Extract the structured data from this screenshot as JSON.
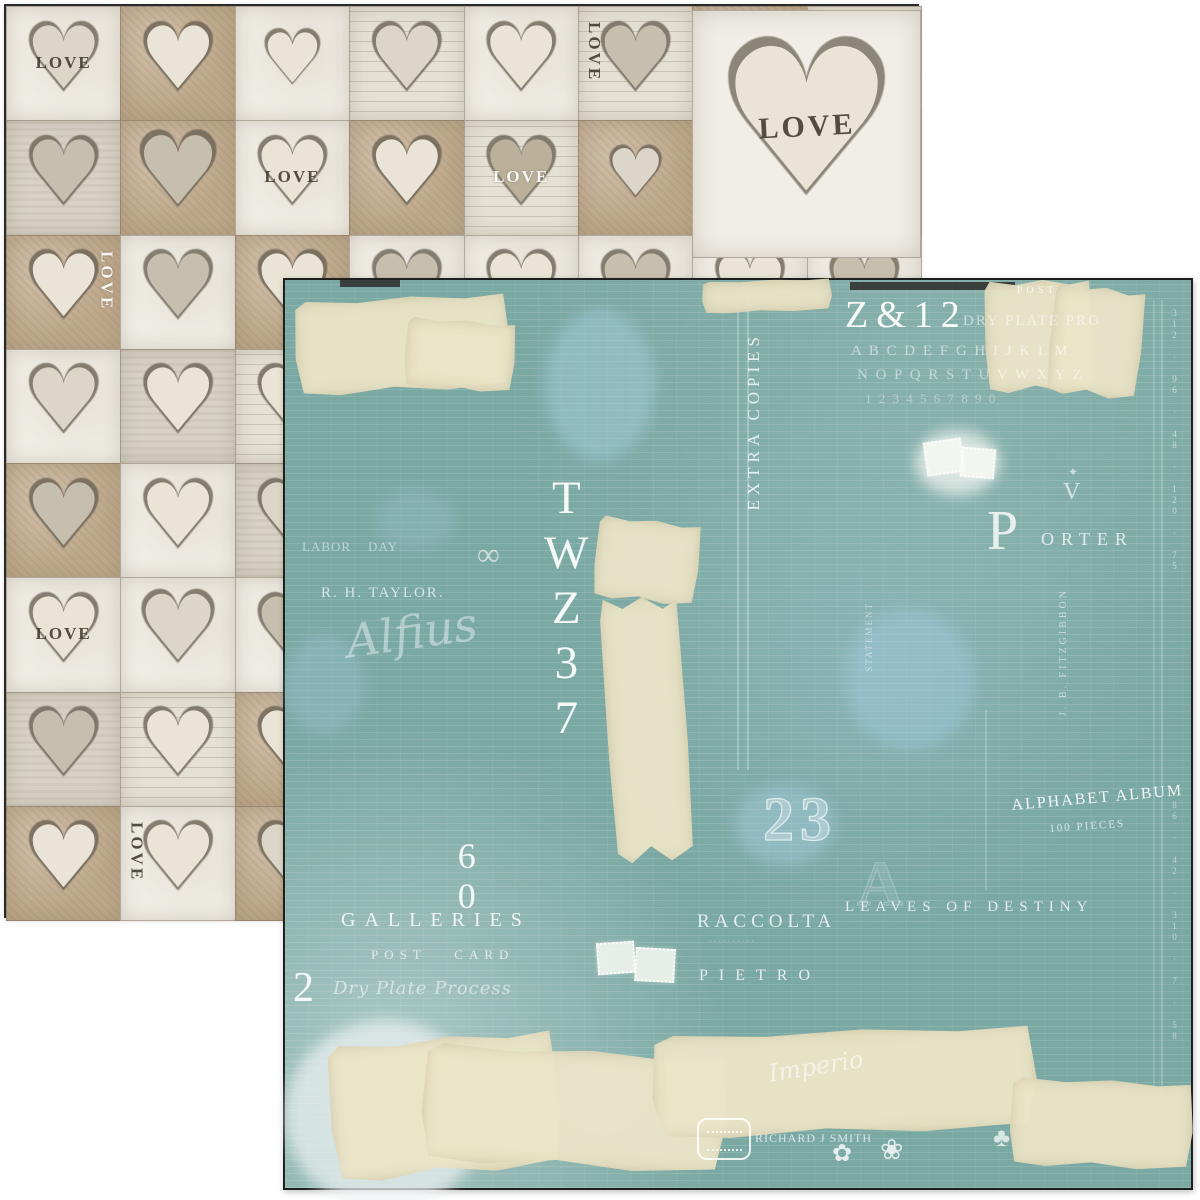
{
  "scene": {
    "description": "Two overlapping square sheets of double-sided vintage scrapbook paper: hearts LOVE pattern side behind, teal ledger typographic collage side in front",
    "background_color": "#ffffff"
  },
  "back_paper": {
    "name": "hearts-love-side",
    "border_color": "#2a2a28",
    "background_color": "#ded8cb",
    "heart_glyph": "♥",
    "love_text": "LOVE",
    "grid": {
      "cols": 8,
      "rows": 8
    },
    "cell_colors": {
      "tan": "#bfa98c",
      "white": "#f0ede5",
      "gray": "#d7d2c5",
      "script": "#e4e0d4"
    },
    "heart_colors": {
      "cream": "#e9e4d6",
      "gray": "#c6bfae",
      "pale": "#dbd6c8",
      "dark": "#bbb09a",
      "outline": "#6b6355"
    },
    "cells": [
      {
        "c": 0,
        "r": 0,
        "b": "white",
        "h": "pale",
        "l": "LOVE",
        "lp": "center",
        "lo": "h",
        "lc": "dark"
      },
      {
        "c": 1,
        "r": 0,
        "b": "tan",
        "h": "cream"
      },
      {
        "c": 2,
        "r": 0,
        "b": "white",
        "h": "cream",
        "s": 0.8
      },
      {
        "c": 3,
        "r": 0,
        "b": "script",
        "h": "pale"
      },
      {
        "c": 4,
        "r": 0,
        "b": "white",
        "h": "cream"
      },
      {
        "c": 5,
        "r": 0,
        "b": "script",
        "h": "gray",
        "l": "LOVE",
        "lp": "left",
        "lo": "v",
        "lc": "dark"
      },
      {
        "c": 0,
        "r": 1,
        "b": "gray",
        "h": "gray"
      },
      {
        "c": 1,
        "r": 1,
        "b": "tan",
        "h": "gray",
        "s": 1.1
      },
      {
        "c": 2,
        "r": 1,
        "b": "white",
        "h": "cream",
        "l": "LOVE",
        "lp": "center",
        "lo": "h",
        "lc": "dark"
      },
      {
        "c": 3,
        "r": 1,
        "b": "tan",
        "h": "cream"
      },
      {
        "c": 4,
        "r": 1,
        "b": "script",
        "h": "dark",
        "l": "LOVE",
        "lp": "center",
        "lo": "h",
        "lc": "white"
      },
      {
        "c": 5,
        "r": 1,
        "b": "tan",
        "h": "pale",
        "s": 0.75
      },
      {
        "c": 0,
        "r": 2,
        "b": "tan",
        "h": "cream",
        "l": "LOVE",
        "lp": "right",
        "lo": "v",
        "lc": "white"
      },
      {
        "c": 1,
        "r": 2,
        "b": "white",
        "h": "gray"
      },
      {
        "c": 2,
        "r": 2,
        "b": "tan",
        "h": "cream"
      },
      {
        "c": 0,
        "r": 3,
        "b": "white",
        "h": "pale"
      },
      {
        "c": 1,
        "r": 3,
        "b": "gray",
        "h": "cream"
      },
      {
        "c": 0,
        "r": 4,
        "b": "tan",
        "h": "gray"
      },
      {
        "c": 1,
        "r": 4,
        "b": "white",
        "h": "cream"
      },
      {
        "c": 0,
        "r": 5,
        "b": "white",
        "h": "cream",
        "l": "LOVE",
        "lp": "center",
        "lo": "h",
        "lc": "dark"
      },
      {
        "c": 1,
        "r": 5,
        "b": "white",
        "h": "pale",
        "s": 1.05
      },
      {
        "c": 0,
        "r": 6,
        "b": "gray",
        "h": "gray"
      },
      {
        "c": 1,
        "r": 6,
        "b": "script",
        "h": "cream"
      },
      {
        "c": 0,
        "r": 7,
        "b": "tan",
        "h": "cream"
      },
      {
        "c": 1,
        "r": 7,
        "b": "white",
        "h": "cream",
        "l": "LOVE",
        "lp": "left",
        "lo": "v",
        "lc": "dark"
      }
    ],
    "big_heart": {
      "label": "LOVE",
      "x": 686,
      "y": 4,
      "w": 229,
      "h": 248
    }
  },
  "front_paper": {
    "name": "teal-ledger-side",
    "border_color": "#1f1f1e",
    "base_color": "#7aa8a2",
    "tape_color": "#ebe4c8",
    "ink_color": "#ffffff",
    "texts": [
      {
        "n": "code-z12",
        "t": "Z&12",
        "x": 560,
        "y": 16,
        "fs": 38,
        "ls": 8,
        "st": "serif",
        "op": 0.95
      },
      {
        "n": "dry-plate-top",
        "t": "Dry Plate Pro",
        "x": 678,
        "y": 34,
        "fs": 15,
        "ls": 2,
        "st": "serifcaps",
        "op": 0.55
      },
      {
        "n": "post-label",
        "t": "POST",
        "x": 732,
        "y": 6,
        "fs": 10,
        "ls": 4,
        "st": "serif",
        "op": 0.75
      },
      {
        "n": "alphabet-row-1",
        "t": "A B C D E F G H I J K L M",
        "x": 566,
        "y": 64,
        "fs": 15,
        "ls": 2,
        "st": "serifcaps",
        "op": 0.55
      },
      {
        "n": "alphabet-row-2",
        "t": "N O P Q R S T U V W X Y Z",
        "x": 572,
        "y": 88,
        "fs": 15,
        "ls": 2,
        "st": "serifcaps",
        "op": 0.5
      },
      {
        "n": "alphabet-row-3",
        "t": "1 2 3 4 5 6 7 8 9 0",
        "x": 580,
        "y": 112,
        "fs": 13,
        "ls": 2,
        "st": "serifcaps",
        "op": 0.38
      },
      {
        "n": "extra-copies",
        "t": "EXTRA COPIES",
        "x": 460,
        "y": 52,
        "fs": 17,
        "ls": 5,
        "st": "vertup",
        "op": 0.8
      },
      {
        "n": "twz37",
        "t": "TWZ37",
        "x": 256,
        "y": 192,
        "fs": 47,
        "ls": 3,
        "st": "vert",
        "op": 0.92
      },
      {
        "n": "infinity-mark",
        "t": "∞",
        "x": 192,
        "y": 258,
        "fs": 32,
        "st": "serif",
        "op": 0.6
      },
      {
        "n": "label-day",
        "t": "Labor    Day",
        "x": 17,
        "y": 260,
        "fs": 13,
        "ls": 1,
        "st": "serifcaps",
        "op": 0.5
      },
      {
        "n": "rh-taylor",
        "t": "R. H. TAYLOR.",
        "x": 36,
        "y": 306,
        "fs": 15,
        "ls": 2,
        "st": "serifcaps",
        "op": 0.7
      },
      {
        "n": "handwriting-1",
        "t": "Alfius",
        "x": 58,
        "y": 338,
        "fs": 46,
        "st": "script",
        "op": 0.42,
        "rot": -8
      },
      {
        "n": "statement-vert",
        "t": "STATEMENT",
        "x": 580,
        "y": 322,
        "fs": 9,
        "ls": 2,
        "st": "vertup",
        "op": 0.5
      },
      {
        "n": "porter-initial",
        "t": "P",
        "x": 702,
        "y": 222,
        "fs": 56,
        "st": "serif",
        "op": 0.8
      },
      {
        "n": "porter-word",
        "t": "ORTER",
        "x": 756,
        "y": 250,
        "fs": 18,
        "ls": 7,
        "st": "serifcaps",
        "op": 0.75
      },
      {
        "n": "crest-ornament",
        "t": "V",
        "x": 778,
        "y": 200,
        "fs": 24,
        "st": "serif",
        "op": 0.65
      },
      {
        "n": "crest-star",
        "t": "✦",
        "x": 783,
        "y": 186,
        "fs": 12,
        "st": "serif",
        "op": 0.6
      },
      {
        "n": "fitzgibbon",
        "t": "J. B. FITZGIBBON",
        "x": 774,
        "y": 308,
        "fs": 10,
        "ls": 3,
        "st": "vertup",
        "op": 0.55
      },
      {
        "n": "alphabet-album",
        "t": "ALPHABET ALBUM",
        "x": 726,
        "y": 518,
        "fs": 16,
        "ls": 2,
        "st": "serifcaps",
        "op": 0.9,
        "rot": -5
      },
      {
        "n": "album-pieces",
        "t": "100 PIECES",
        "x": 764,
        "y": 544,
        "fs": 11,
        "ls": 2,
        "st": "serifcaps",
        "op": 0.7,
        "rot": -4
      },
      {
        "n": "number-23",
        "t": "23",
        "x": 478,
        "y": 508,
        "fs": 62,
        "ls": 6,
        "st": "outline",
        "op": 0.8
      },
      {
        "n": "number-60",
        "t": "60",
        "x": 162,
        "y": 556,
        "fs": 36,
        "st": "vert",
        "op": 0.9
      },
      {
        "n": "galleries",
        "t": "GALLERIES",
        "x": 56,
        "y": 630,
        "fs": 20,
        "ls": 9,
        "st": "serifcaps",
        "op": 0.85
      },
      {
        "n": "post-card",
        "t": "POST   CARD",
        "x": 86,
        "y": 668,
        "fs": 13,
        "ls": 6,
        "st": "serifcaps",
        "op": 0.7
      },
      {
        "n": "number-2",
        "t": "2",
        "x": 8,
        "y": 686,
        "fs": 42,
        "st": "serif",
        "op": 0.9
      },
      {
        "n": "dry-plate-process",
        "t": "Dry Plate Process",
        "x": 48,
        "y": 700,
        "fs": 18,
        "ls": 1,
        "st": "script",
        "op": 0.55
      },
      {
        "n": "raccolta",
        "t": "RACCOLTA",
        "x": 412,
        "y": 632,
        "fs": 19,
        "ls": 5,
        "st": "serifcaps",
        "op": 0.8
      },
      {
        "n": "raccolta-sub",
        "t": "· · · · · · · · · ·",
        "x": 424,
        "y": 658,
        "fs": 8,
        "st": "serif",
        "op": 0.5
      },
      {
        "n": "leaves-of-destiny",
        "t": "LEAVES OF DESTINY",
        "x": 560,
        "y": 620,
        "fs": 15,
        "ls": 6,
        "st": "serifcaps",
        "op": 0.8
      },
      {
        "n": "pietro",
        "t": "PIETRO",
        "x": 414,
        "y": 688,
        "fs": 16,
        "ls": 11,
        "st": "serifcaps",
        "op": 0.8
      },
      {
        "n": "drafting-a",
        "t": "A",
        "x": 572,
        "y": 570,
        "fs": 64,
        "st": "outline",
        "op": 0.28
      },
      {
        "n": "handwriting-2",
        "t": "Imperio",
        "x": 482,
        "y": 782,
        "fs": 24,
        "st": "script",
        "op": 0.6,
        "rot": -9
      },
      {
        "n": "richard-smith",
        "t": "Richard J Smith",
        "x": 470,
        "y": 852,
        "fs": 12,
        "ls": 1,
        "st": "serifcaps",
        "op": 0.7
      },
      {
        "n": "flower-1",
        "t": "✿",
        "x": 547,
        "y": 862,
        "fs": 24,
        "st": "serif",
        "op": 0.8
      },
      {
        "n": "flower-2",
        "t": "❀",
        "x": 595,
        "y": 856,
        "fs": 28,
        "st": "serif",
        "op": 0.8
      },
      {
        "n": "clover-sprig",
        "t": "♣",
        "x": 708,
        "y": 844,
        "fs": 26,
        "st": "serif",
        "op": 0.7
      },
      {
        "n": "ledger-numbers-right",
        "t": "312 · 96 · 48 · 120 · 75",
        "x": 884,
        "y": 28,
        "fs": 9,
        "ls": 1,
        "st": "vert",
        "op": 0.55
      },
      {
        "n": "ledger-numbers-right-2",
        "t": "86 · 42 · 310 · 7 · 58",
        "x": 884,
        "y": 520,
        "fs": 9,
        "ls": 1,
        "st": "vert",
        "op": 0.5
      }
    ],
    "tapes": [
      {
        "x": 10,
        "y": 17,
        "w": 215,
        "h": 95,
        "rot": -3
      },
      {
        "x": 120,
        "y": 40,
        "w": 110,
        "h": 70,
        "rot": 4
      },
      {
        "x": 417,
        "y": 0,
        "w": 130,
        "h": 32,
        "rot": -2
      },
      {
        "x": 700,
        "y": 0,
        "w": 108,
        "h": 112,
        "rot": -2
      },
      {
        "x": 765,
        "y": 7,
        "w": 92,
        "h": 110,
        "rot": 6
      },
      {
        "x": 310,
        "y": 240,
        "w": 104,
        "h": 82,
        "rot": 6
      },
      {
        "x": 322,
        "y": 317,
        "w": 80,
        "h": 265,
        "rot": -4
      },
      {
        "x": 45,
        "y": 757,
        "w": 230,
        "h": 138,
        "rot": -5
      },
      {
        "x": 137,
        "y": 770,
        "w": 305,
        "h": 118,
        "rot": 3
      },
      {
        "x": 367,
        "y": 750,
        "w": 385,
        "h": 104,
        "rot": -2
      },
      {
        "x": 725,
        "y": 800,
        "w": 183,
        "h": 88,
        "rot": 2
      }
    ],
    "splotches": [
      {
        "x": 260,
        "y": 30,
        "w": 110,
        "h": 150,
        "color": "#a3cede",
        "op": 0.5
      },
      {
        "x": 560,
        "y": 330,
        "w": 130,
        "h": 140,
        "color": "#9dc8dd",
        "op": 0.5
      },
      {
        "x": 0,
        "y": 355,
        "w": 80,
        "h": 100,
        "color": "#9dc4d6",
        "op": 0.4
      },
      {
        "x": 90,
        "y": 210,
        "w": 80,
        "h": 60,
        "color": "#9ec6d4",
        "op": 0.3
      },
      {
        "x": 450,
        "y": 505,
        "w": 100,
        "h": 80,
        "color": "#a7cde0",
        "op": 0.45
      },
      {
        "x": 270,
        "y": 775,
        "w": 100,
        "h": 80,
        "color": "#9cc6da",
        "op": 0.5
      },
      {
        "x": 0,
        "y": 740,
        "w": 200,
        "h": 190,
        "color": "#eef3f3",
        "op": 0.7
      },
      {
        "x": 630,
        "y": 150,
        "w": 85,
        "h": 65,
        "color": "#f1f4f0",
        "op": 0.75
      }
    ],
    "stamps": [
      {
        "x": 640,
        "y": 160,
        "w": 34,
        "h": 30,
        "rot": -8
      },
      {
        "x": 676,
        "y": 168,
        "w": 30,
        "h": 26,
        "rot": 5
      },
      {
        "x": 312,
        "y": 662,
        "w": 34,
        "h": 28,
        "rot": -4
      },
      {
        "x": 350,
        "y": 668,
        "w": 36,
        "h": 30,
        "rot": 3
      }
    ],
    "rules": [
      {
        "x": 452,
        "y": 10,
        "h": 480,
        "op": 0.5
      },
      {
        "x": 462,
        "y": 10,
        "h": 480,
        "op": 0.5
      },
      {
        "x": 700,
        "y": 430,
        "h": 180,
        "op": 0.35
      },
      {
        "x": 876,
        "y": 20,
        "h": 860,
        "op": 0.4
      },
      {
        "x": 868,
        "y": 20,
        "h": 860,
        "op": 0.3
      }
    ],
    "dark_strips": [
      {
        "x": 565,
        "y": 2,
        "w": 165,
        "h": 8
      },
      {
        "x": 55,
        "y": 0,
        "w": 60,
        "h": 7
      }
    ],
    "seal": {
      "x": 412,
      "y": 838,
      "w": 54,
      "h": 42
    }
  }
}
